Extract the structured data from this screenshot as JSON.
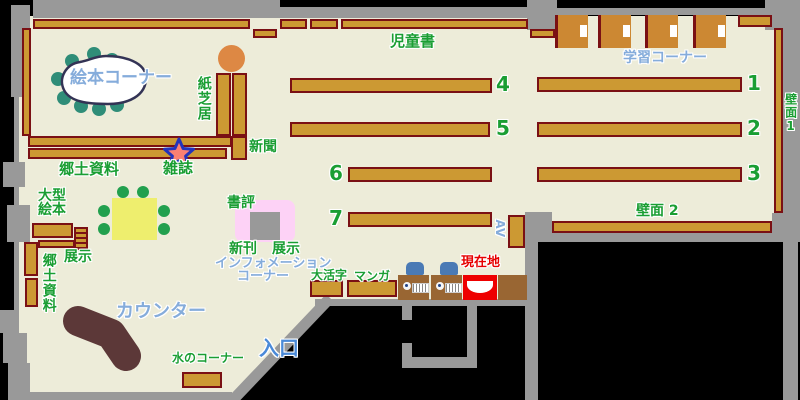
{
  "areas": {
    "ehon_corner": "絵本コーナー",
    "kamishibai": "紙芝居",
    "shinbun": "新聞",
    "zasshi": "雑誌",
    "kyodo_shiryo": "郷土資料",
    "jidosho": "児童書",
    "gakushu_corner": "学習コーナー",
    "hekimen_1": "壁面1",
    "hekimen_2": "壁面 2",
    "ogata_ehon_line1": "大型",
    "ogata_ehon_line2": "絵本",
    "kyodo_shiryo_shelf": "郷土資料",
    "tenji_left": "展示",
    "shohyo": "書評",
    "shinkan": "新刊",
    "tenji_right": "展示",
    "information_line1": "インフォメーション",
    "information_line2": "コーナー",
    "daikatsuji": "大活字",
    "manga": "マンガ",
    "genzaichi": "現在地",
    "av": "AV",
    "counter": "カウンター",
    "mizu_corner": "水のコーナー",
    "iriguchi": "入口"
  },
  "shelf_numbers": {
    "s1": "1",
    "s2": "2",
    "s3": "3",
    "s4": "4",
    "s5": "5",
    "s6": "6",
    "s7": "7"
  },
  "markers": {
    "zasshi_star": "star-icon",
    "genzaichi_marker": "you-are-here-icon"
  },
  "colors": {
    "floor": "#edecd9",
    "wall": "#999999",
    "outside": "#000000",
    "shelf_fill": "#cc9933",
    "shelf_border": "#7a1014",
    "pc_desk_brown": "#996633",
    "carrel_orange": "#cc8833",
    "stool_teal": "#2f8d78",
    "chair_green": "#22a04e",
    "table_yellow": "#eeee6e",
    "counter_brown": "#5c3838",
    "display_pink": "#fdd2f6",
    "marker_red": "#ee0000",
    "label_green": "#1a9e33",
    "label_blue": "#85acdb",
    "entrance_blue": "#4a8ad8",
    "chair_blue": "#4a7ab5",
    "stool_orange": "#dd8844",
    "star_fill": "#fa8072",
    "star_border": "#2233bb"
  }
}
